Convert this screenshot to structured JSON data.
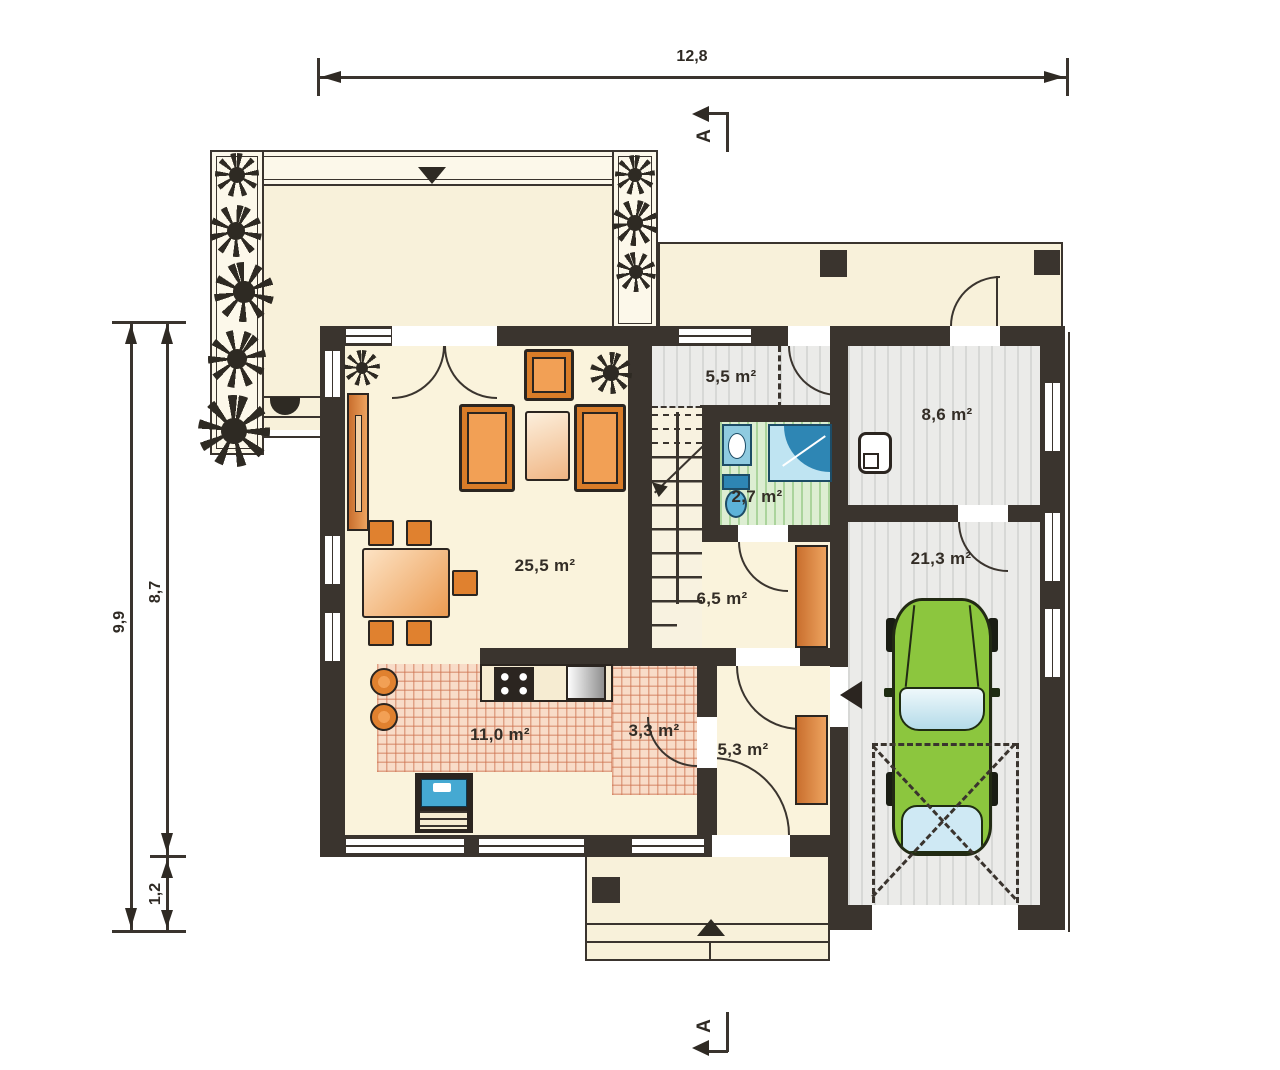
{
  "title": "House ground floor plan",
  "dimensions": {
    "width_total": "12,8",
    "height_total": "9,9",
    "height_main": "8,7",
    "height_lower": "1,2"
  },
  "section_markers": {
    "top": "A",
    "bottom": "A"
  },
  "rooms": [
    {
      "id": "living-room",
      "label": "25,5 m²"
    },
    {
      "id": "entrance-hall",
      "label": "5,5 m²"
    },
    {
      "id": "bathroom",
      "label": "2,7 m²"
    },
    {
      "id": "utility-room",
      "label": "8,6 m²"
    },
    {
      "id": "garage",
      "label": "21,3 m²"
    },
    {
      "id": "corridor",
      "label": "6,5 m²"
    },
    {
      "id": "kitchen",
      "label": "11,0 m²"
    },
    {
      "id": "pantry",
      "label": "3,3 m²"
    },
    {
      "id": "vestibule",
      "label": "5,3 m²"
    }
  ],
  "colors": {
    "wall": "#3a342e",
    "floor_cream": "#faf3dc",
    "floor_gray": "#ebebe9",
    "floor_green": "#ddeed2",
    "floor_pink": "#f8dcc8",
    "furniture_orange": "#e0812f",
    "wood_brown": "#c96f2e",
    "car_green": "#8cc63e",
    "fixture_blue": "#3f9fc8"
  },
  "icons": {
    "plant": "starburst-plant",
    "car": "car-top-view",
    "entry_arrow": "solid-triangle",
    "section_arrow": "solid-triangle"
  }
}
